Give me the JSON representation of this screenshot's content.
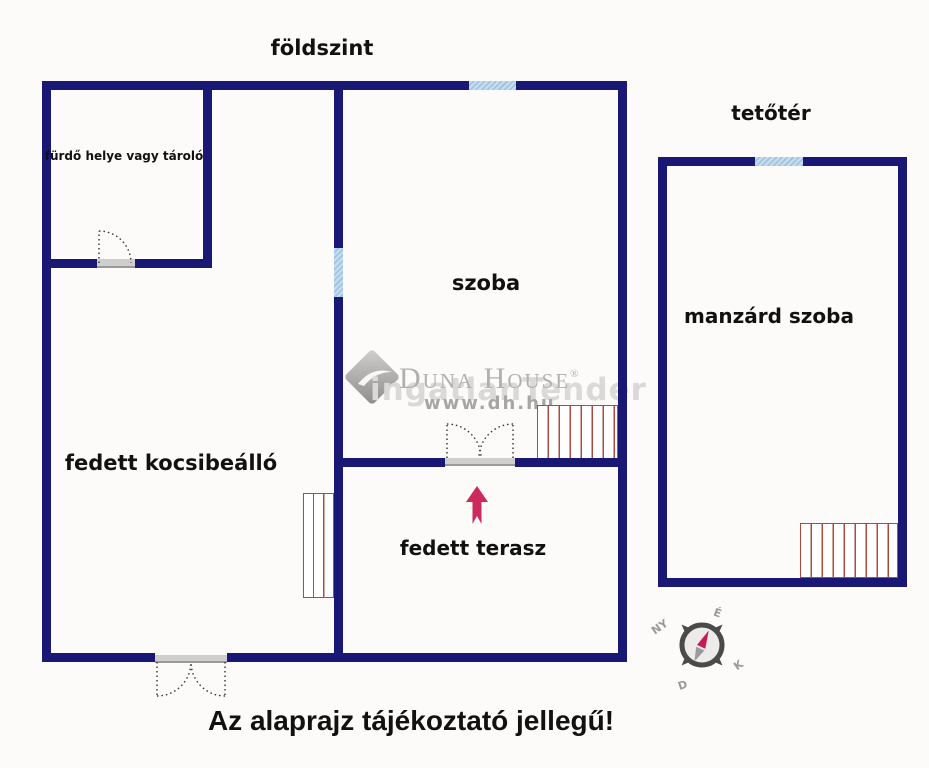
{
  "titles": {
    "ground_floor": "földszint",
    "attic": "tetőtér"
  },
  "rooms": {
    "bathroom_storage": "fürdő helye vagy tároló",
    "room": "szoba",
    "carport": "fedett kocsibeálló",
    "terrace": "fedett terasz",
    "mansard_room": "manzárd szoba"
  },
  "disclaimer": "Az alaprajz tájékoztató jellegű!",
  "watermark": {
    "brand": "Duna House",
    "registered": "®",
    "url": "www.dh.hu",
    "ghost_text": "ingatlanTender"
  },
  "compass": {
    "north": "É",
    "west": "NY",
    "east": "K",
    "south": "D"
  },
  "colors": {
    "wall_navy": "#191975",
    "window_blue": "#b9d3e9",
    "stairs_red": "#b04a3e",
    "arrow_crimson": "#cc2a5c",
    "label_black": "#111111",
    "watermark_gray": "#b2b0ae",
    "compass_gray": "#4a4a4a",
    "background": "#fcfbf9"
  }
}
